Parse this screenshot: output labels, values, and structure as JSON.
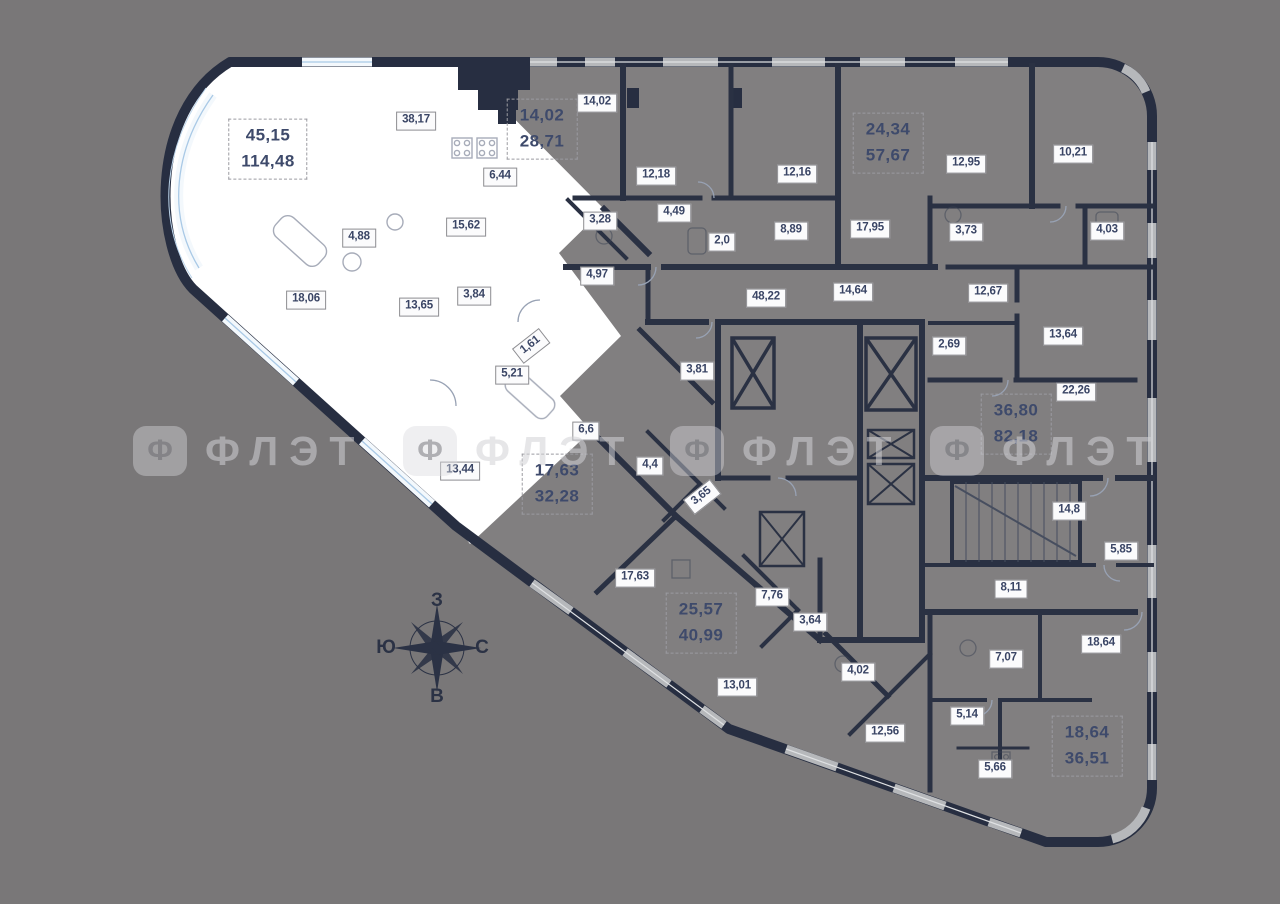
{
  "plan": {
    "title": "floor-plan",
    "colors": {
      "background": "#797778",
      "building_fill": "#817f80",
      "apartment_fill": "#ffffff",
      "wall": "#272e41",
      "window_gray": "#b6b8bb",
      "window_white": "#f3f8fc",
      "window_blue_line": "#a9c9e6",
      "label_text": "#3a4565",
      "dashed_label_text": "#3e4a6b",
      "compass": "#2b3245"
    },
    "highlighted_apartment": {
      "living_area": "45,15",
      "total_area": "114,48"
    },
    "apartment_summaries": [
      {
        "line1": "45,15",
        "line2": "114,48",
        "x": 268,
        "y": 149,
        "highlighted": true
      },
      {
        "line1": "14,02",
        "line2": "28,71",
        "x": 542,
        "y": 129,
        "highlighted": false
      },
      {
        "line1": "24,34",
        "line2": "57,67",
        "x": 888,
        "y": 143,
        "highlighted": false
      },
      {
        "line1": "36,80",
        "line2": "82,18",
        "x": 1016,
        "y": 424,
        "highlighted": false
      },
      {
        "line1": "17,63",
        "line2": "32,28",
        "x": 557,
        "y": 484,
        "highlighted": false
      },
      {
        "line1": "25,57",
        "line2": "40,99",
        "x": 701,
        "y": 623,
        "highlighted": false
      },
      {
        "line1": "18,64",
        "line2": "36,51",
        "x": 1087,
        "y": 746,
        "highlighted": false
      }
    ],
    "room_labels": [
      {
        "t": "38,17",
        "x": 416,
        "y": 121
      },
      {
        "t": "6,44",
        "x": 500,
        "y": 177
      },
      {
        "t": "14,02",
        "x": 597,
        "y": 103
      },
      {
        "t": "12,18",
        "x": 656,
        "y": 176
      },
      {
        "t": "3,28",
        "x": 600,
        "y": 221
      },
      {
        "t": "4,49",
        "x": 674,
        "y": 213
      },
      {
        "t": "2,0",
        "x": 722,
        "y": 242
      },
      {
        "t": "8,89",
        "x": 791,
        "y": 231
      },
      {
        "t": "12,16",
        "x": 797,
        "y": 174
      },
      {
        "t": "17,95",
        "x": 870,
        "y": 229
      },
      {
        "t": "12,95",
        "x": 966,
        "y": 164
      },
      {
        "t": "10,21",
        "x": 1073,
        "y": 154
      },
      {
        "t": "3,73",
        "x": 966,
        "y": 232
      },
      {
        "t": "4,03",
        "x": 1107,
        "y": 231
      },
      {
        "t": "4,88",
        "x": 359,
        "y": 238
      },
      {
        "t": "15,62",
        "x": 466,
        "y": 227
      },
      {
        "t": "4,97",
        "x": 597,
        "y": 276
      },
      {
        "t": "48,22",
        "x": 766,
        "y": 298
      },
      {
        "t": "14,64",
        "x": 853,
        "y": 292
      },
      {
        "t": "12,67",
        "x": 988,
        "y": 293
      },
      {
        "t": "18,06",
        "x": 306,
        "y": 300
      },
      {
        "t": "13,65",
        "x": 419,
        "y": 307
      },
      {
        "t": "3,84",
        "x": 474,
        "y": 296
      },
      {
        "t": "13,64",
        "x": 1063,
        "y": 336
      },
      {
        "t": "1,61",
        "x": 531,
        "y": 346,
        "r": -38
      },
      {
        "t": "2,69",
        "x": 949,
        "y": 346
      },
      {
        "t": "22,26",
        "x": 1076,
        "y": 392
      },
      {
        "t": "5,21",
        "x": 512,
        "y": 375
      },
      {
        "t": "3,81",
        "x": 697,
        "y": 371
      },
      {
        "t": "6,6",
        "x": 586,
        "y": 431
      },
      {
        "t": "4,4",
        "x": 650,
        "y": 466
      },
      {
        "t": "3,65",
        "x": 702,
        "y": 497,
        "r": -38
      },
      {
        "t": "13,44",
        "x": 460,
        "y": 471
      },
      {
        "t": "14,8",
        "x": 1069,
        "y": 511
      },
      {
        "t": "5,85",
        "x": 1121,
        "y": 551
      },
      {
        "t": "8,11",
        "x": 1011,
        "y": 589
      },
      {
        "t": "17,63",
        "x": 635,
        "y": 578
      },
      {
        "t": "7,76",
        "x": 772,
        "y": 597
      },
      {
        "t": "3,64",
        "x": 810,
        "y": 622
      },
      {
        "t": "4,02",
        "x": 858,
        "y": 672
      },
      {
        "t": "13,01",
        "x": 737,
        "y": 687
      },
      {
        "t": "12,56",
        "x": 885,
        "y": 733
      },
      {
        "t": "7,07",
        "x": 1006,
        "y": 659
      },
      {
        "t": "18,64",
        "x": 1101,
        "y": 644
      },
      {
        "t": "5,14",
        "x": 967,
        "y": 716
      },
      {
        "t": "5,66",
        "x": 995,
        "y": 769
      }
    ],
    "compass": {
      "top": "З",
      "left": "Ю",
      "right": "С",
      "bottom": "В",
      "center_x": 437,
      "center_y": 648
    },
    "watermark": {
      "logo_letter": "Ф",
      "text": "ФЛЭТ",
      "y": 451,
      "positions_x": [
        133,
        403,
        670,
        930
      ]
    }
  }
}
